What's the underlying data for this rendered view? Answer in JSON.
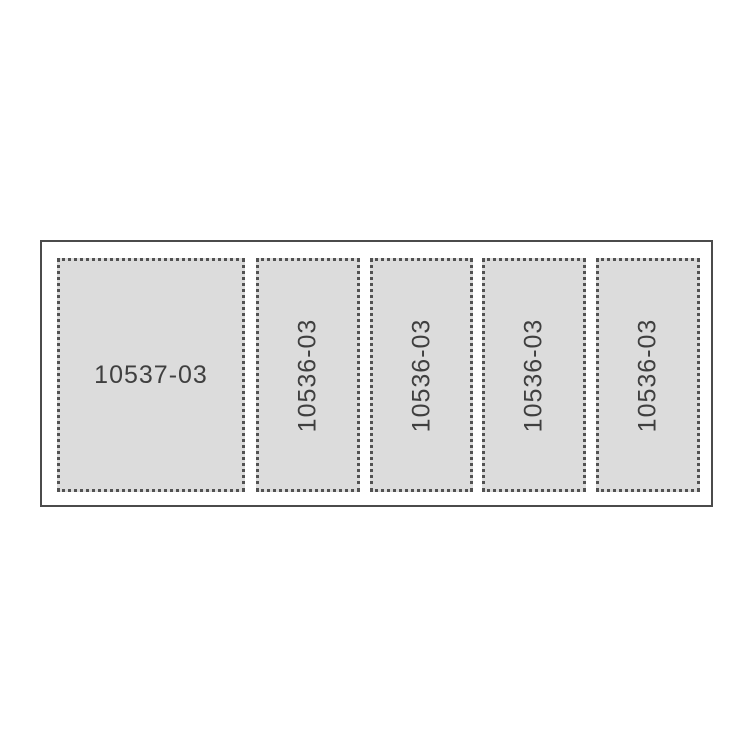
{
  "diagram": {
    "type": "label-sheet-layout",
    "sheet": {
      "panels": [
        {
          "label": "10537-03",
          "orientation": "horizontal"
        },
        {
          "label": "10536-03",
          "orientation": "vertical"
        },
        {
          "label": "10536-03",
          "orientation": "vertical"
        },
        {
          "label": "10536-03",
          "orientation": "vertical"
        },
        {
          "label": "10536-03",
          "orientation": "vertical"
        }
      ]
    },
    "colors": {
      "background": "#ffffff",
      "sheet_outline": "#4b4b4b",
      "panel_fill": "#dcdcdc",
      "panel_dotted_border": "#525252",
      "label_text": "#3f3f3f"
    }
  }
}
